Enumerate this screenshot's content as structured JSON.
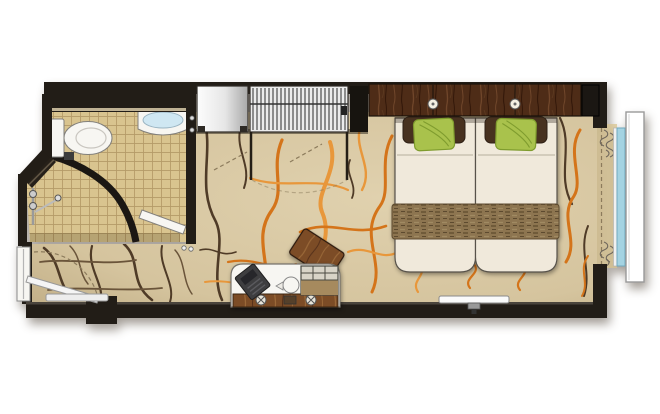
{
  "page": {
    "type": "stateroom-floor-plan",
    "background": "#ffffff"
  },
  "colors": {
    "wall": "#221d17",
    "wall-edge": "#4a443c",
    "carpet-base": "#d5c49e",
    "carpet-light": "#e0d1ae",
    "carpet-vein-orange": "#d4741a",
    "carpet-vein-orange-light": "#e8973b",
    "carpet-vein-brown": "#4f3b27",
    "carpet-vein-brown-light": "#6a543a",
    "tile-base": "#d9c48f",
    "tile-grout": "#b49a67",
    "fixture-white": "#f7f6f2",
    "fixture-stroke": "#82807c",
    "basin-blue": "#cfe7f2",
    "glass-blue": "#a4d3e2",
    "wood-dark": "#4e2c17",
    "wood-dark-grain-light": "#70462a",
    "wood-dark-grain-dark": "#35190a",
    "wood-mid": "#7c4c26",
    "wood-mid-grain-light": "#9a6838",
    "wood-mid-grain-dark": "#55301a",
    "linen": "#f0e9db",
    "pillow-green": "#a9c24c",
    "pillow-green-line": "#7f9c2e",
    "pillow-brown": "#47311f",
    "runner-base": "#8d7550",
    "runner-dash-dark": "#675233",
    "runner-dash-light": "#a08a62",
    "cabinet-light": "#fdfdfd",
    "cabinet-dark": "#a8a8a8",
    "stripe": "#4c4c4c",
    "swing-line": "#8c7b5c",
    "curtain": "#6f675c",
    "frame-white": "#ffffff",
    "tv-white": "#fafafa"
  },
  "rooms": [
    {
      "name": "bathroom"
    },
    {
      "name": "shower"
    },
    {
      "name": "entry-vestibule"
    },
    {
      "name": "main-cabin"
    },
    {
      "name": "window-bay"
    }
  ],
  "fixtures": [
    {
      "name": "toilet"
    },
    {
      "name": "washbasin"
    },
    {
      "name": "shower-set"
    },
    {
      "name": "shower-glass-wall"
    },
    {
      "name": "entry-door"
    },
    {
      "name": "bathroom-door"
    },
    {
      "name": "cabinet"
    },
    {
      "name": "wardrobe"
    },
    {
      "name": "headboard"
    },
    {
      "name": "reading-light",
      "count": 2
    },
    {
      "name": "twin-bed",
      "count": 2
    },
    {
      "name": "green-pillow",
      "count": 2
    },
    {
      "name": "brown-pillow",
      "count": 2
    },
    {
      "name": "bed-runner"
    },
    {
      "name": "nightstand"
    },
    {
      "name": "desk"
    },
    {
      "name": "desk-chair"
    },
    {
      "name": "telephone"
    },
    {
      "name": "minibar-tray"
    },
    {
      "name": "kettle"
    },
    {
      "name": "wall-tv"
    },
    {
      "name": "curtains"
    },
    {
      "name": "window-glass"
    },
    {
      "name": "balcony-frame"
    }
  ]
}
